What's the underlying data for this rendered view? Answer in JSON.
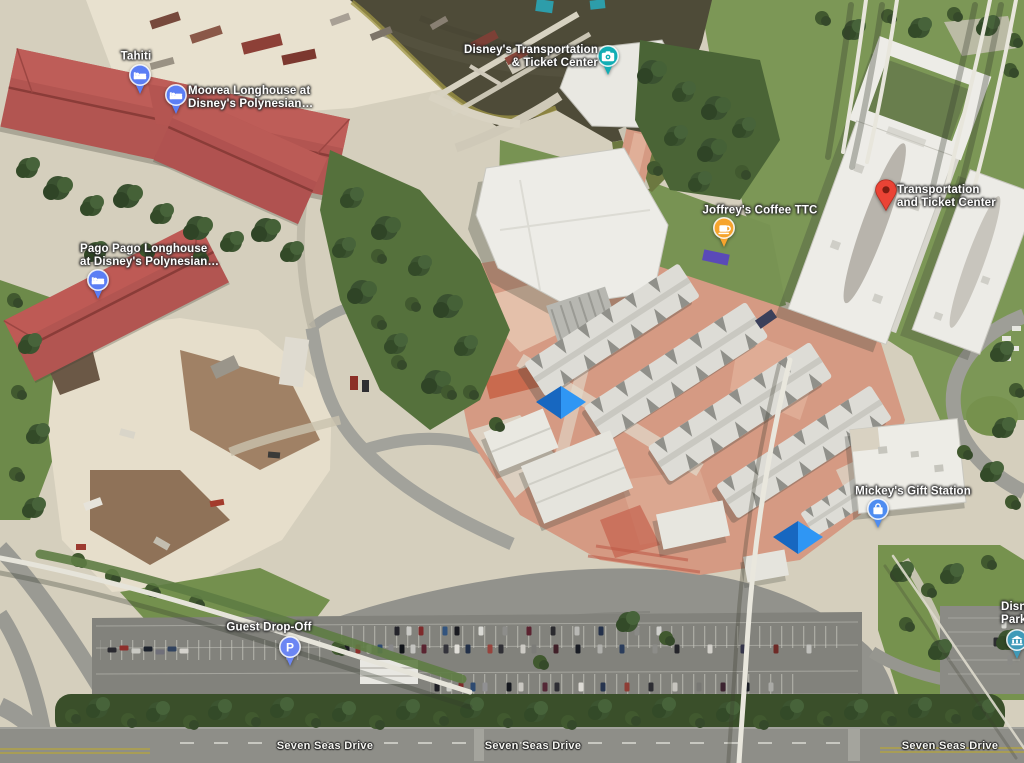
{
  "map_type": "satellite",
  "pois": {
    "tahiti": {
      "label": "Tahiti",
      "icon": "lodging-icon",
      "pin_color": "#5b7ef4"
    },
    "moorea": {
      "line1": "Moorea Longhouse at",
      "line2": "Disney's Polynesian…",
      "icon": "lodging-icon",
      "pin_color": "#5b7ef4"
    },
    "pago_pago": {
      "line1": "Pago Pago Longhouse",
      "line2": "at Disney's Polynesian…",
      "icon": "lodging-icon",
      "pin_color": "#5b7ef4"
    },
    "ttc_ferry": {
      "line1": "Disney's Transportation",
      "line2": "& Ticket Center",
      "icon": "camera-icon",
      "pin_color": "#12adb4"
    },
    "joffreys": {
      "label": "Joffrey's Coffee TTC",
      "icon": "coffee-icon",
      "pin_color": "#f6a42d"
    },
    "ttc_marker": {
      "line1": "Transportation",
      "line2": "and Ticket Center",
      "icon": "red-map-pin",
      "pin_color": "#ea4335"
    },
    "mickeys_gift": {
      "label": "Mickey's Gift Station",
      "icon": "shopping-bag-icon",
      "pin_color": "#4e8cf0"
    },
    "guest_dropoff": {
      "label": "Guest Drop-Off",
      "icon": "parking-icon",
      "pin_color": "#6c86f3"
    },
    "edge_partial": {
      "line1": "Disn",
      "line2": "Park",
      "icon": "transit-station-icon",
      "pin_color": "#3f9ab8"
    }
  },
  "road_labels": {
    "seven_seas_drive": "Seven Seas Drive"
  },
  "colors": {
    "water": "#4e4b38",
    "grass": "#7c9756",
    "trees": "#3d5530",
    "sand": "#e8e1cf",
    "dirt": "#9b7f63",
    "road": "#95958f",
    "red_roof": "#b25551",
    "white_roof": "#edece7",
    "plaza": "#d59a83",
    "blue_canopy_dark": "#1767c0",
    "blue_canopy_light": "#2f96f4"
  }
}
